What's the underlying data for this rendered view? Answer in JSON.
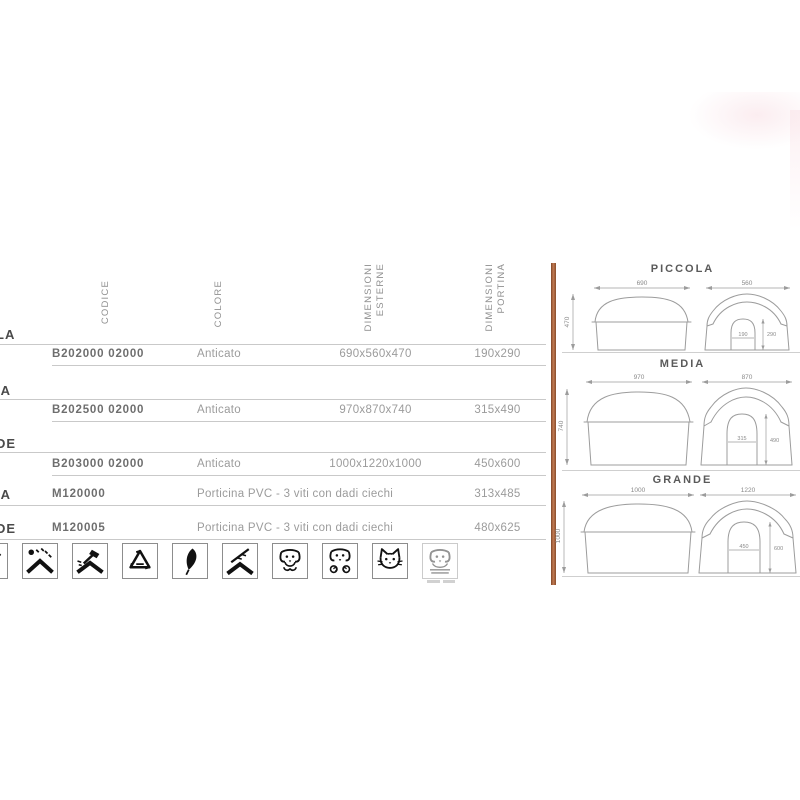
{
  "colors": {
    "divider": "#b26b44",
    "table_line": "#c9c9c9",
    "text_muted": "#9b9b9b",
    "text_strong": "#4a4a4a"
  },
  "table": {
    "headers": {
      "codice": "CODICE",
      "colore": "COLORE",
      "dim_esterne_1": "DIMENSIONI",
      "dim_esterne_2": "ESTERNE",
      "dim_portina_1": "DIMENSIONI",
      "dim_portina_2": "PORTINA"
    },
    "rows": [
      {
        "label": "LA",
        "code": "B202000 02000",
        "colore": "Anticato",
        "esterne": "690x560x470",
        "portina": "190x290"
      },
      {
        "label": "IA",
        "code": "B202500 02000",
        "colore": "Anticato",
        "esterne": "970x870x740",
        "portina": "315x490"
      },
      {
        "label": "DE",
        "code": "B203000 02000",
        "colore": "Anticato",
        "esterne": "1000x1220x1000",
        "portina": "450x600"
      },
      {
        "label": "IA",
        "code": "M120000",
        "colore": "Porticina PVC - 3 viti con dadi ciechi",
        "portina": "313x485"
      },
      {
        "label": "DE",
        "code": "M120005",
        "colore": "Porticina PVC - 3 viti con dadi ciechi",
        "portina": "480x625"
      }
    ]
  },
  "icons": [
    {
      "name": "clipped-icon"
    },
    {
      "name": "weather-uv-icon"
    },
    {
      "name": "hammer-assembly-icon"
    },
    {
      "name": "recycling-icon"
    },
    {
      "name": "feather-icon"
    },
    {
      "name": "branch-roof-icon"
    },
    {
      "name": "dog-face-icon"
    },
    {
      "name": "dog-paws-icon"
    },
    {
      "name": "cat-face-icon"
    },
    {
      "name": "faded-dog-icon"
    }
  ],
  "diagrams": {
    "sections": [
      {
        "title": "PICCOLA",
        "side_width": "690",
        "side_height": "470",
        "front_width": "560",
        "door_width": "190",
        "door_height": "290"
      },
      {
        "title": "MEDIA",
        "side_width": "970",
        "side_height": "740",
        "front_width": "870",
        "door_width": "315",
        "door_height": "490"
      },
      {
        "title": "GRANDE",
        "side_width": "1000",
        "side_height": "1000",
        "front_width": "1220",
        "door_width": "450",
        "door_height": "600"
      }
    ]
  }
}
